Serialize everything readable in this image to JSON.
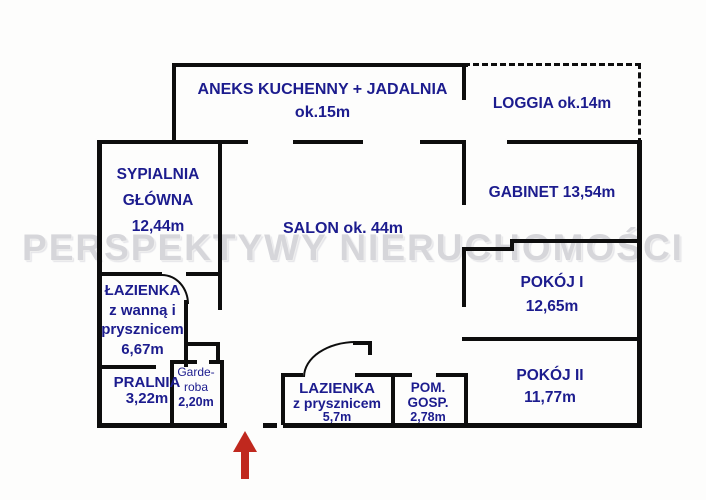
{
  "plan": {
    "watermark": "PERSPEKTYWY NIERUCHOMOŚCI",
    "entrance_arrow": "entrance-up"
  },
  "colors": {
    "label": "#1c1c8e",
    "wall": "#0d0d0d",
    "watermark": "#d6d6da",
    "arrow": "#c0281e",
    "background": "#fdfdfc"
  },
  "rooms": {
    "aneks": {
      "lines": [
        "ANEKS KUCHENNY + JADALNIA",
        "ok.15m"
      ]
    },
    "loggia": {
      "lines": [
        "LOGGIA ok.14m"
      ]
    },
    "sypialnia": {
      "lines": [
        "SYPIALNIA",
        "GŁÓWNA",
        "12,44m"
      ]
    },
    "salon": {
      "lines": [
        "SALON ok. 44m"
      ]
    },
    "gabinet": {
      "lines": [
        "GABINET 13,54m"
      ]
    },
    "pokoj_1": {
      "lines": [
        "POKÓJ I",
        "12,65m"
      ]
    },
    "pokoj_2": {
      "lines": [
        "POKÓJ II",
        "11,77m"
      ]
    },
    "lazienka_wanna": {
      "lines": [
        "ŁAZIENKA",
        "z wanną i",
        "prysznicem",
        "6,67m"
      ]
    },
    "pralnia": {
      "lines": [
        "PRALNIA",
        "3,22m"
      ]
    },
    "garderoba": {
      "lines": [
        "Garde-",
        "roba",
        "2,20m"
      ]
    },
    "lazienka_prysznic": {
      "lines": [
        "LAZIENKA",
        "z prysznicem",
        "5,7m"
      ]
    },
    "pom_gosp": {
      "lines": [
        "POM.",
        "GOSP.",
        "2,78m"
      ]
    }
  }
}
